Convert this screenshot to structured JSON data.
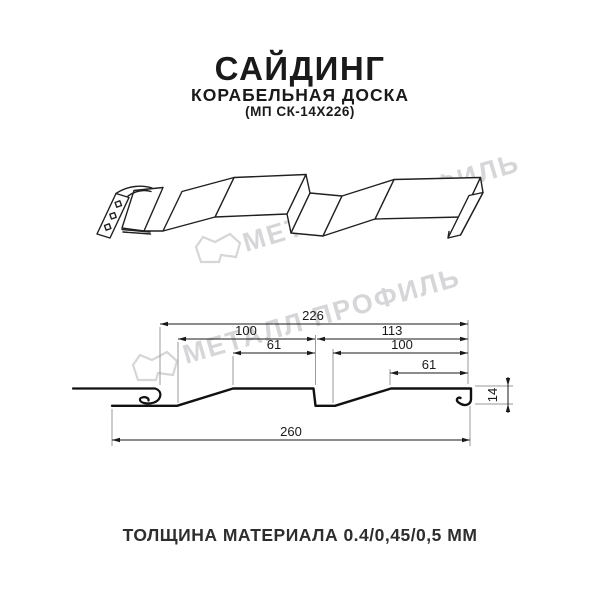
{
  "header": {
    "title": "САЙДИНГ",
    "subtitle": "КОРАБЕЛЬНАЯ ДОСКА",
    "model": "(МП СК-14Х226)"
  },
  "watermark": {
    "text": "МЕТАЛЛ ПРОФИЛЬ",
    "color": "#d6d6d9"
  },
  "section_dimensions": {
    "pitch": "226",
    "left_wave_width": "100",
    "left_wave_top": "61",
    "right_pitch": "113",
    "right_wave_width": "100",
    "right_wave_top": "61",
    "profile_height": "14",
    "total_width": "260"
  },
  "footer": {
    "thickness_label": "ТОЛЩИНА МАТЕРИАЛА 0.4/0,45/0,5 ММ"
  },
  "colors": {
    "profile_line": "#111111",
    "dimension_line": "#1a1a1a",
    "extension_line": "#9a9a9a"
  }
}
